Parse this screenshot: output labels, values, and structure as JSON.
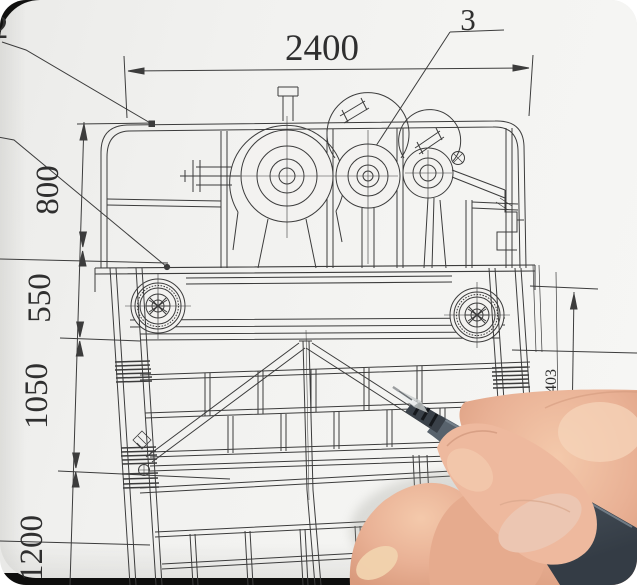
{
  "dimensions": {
    "top_width": "2400",
    "left_chain": [
      "800",
      "550",
      "1050",
      "1200"
    ],
    "right_height": "1403"
  },
  "callouts": {
    "part_top_left": "2",
    "part_top_right": "3"
  },
  "colors": {
    "paper": "#f2f1ef",
    "drawing_line": "#3c3c3c",
    "photo_border": "#0e0e0d",
    "pen_barrel": "#4d565f",
    "pen_grip": "#3a4149",
    "pen_ring": "#16191d",
    "pen_tip_plastic": "#d7dadb",
    "skin": "#e8af93",
    "skin_highlight": "#f6d2b5",
    "nail": "#f1d3ae",
    "thumbnail": "#ecc6b2"
  }
}
